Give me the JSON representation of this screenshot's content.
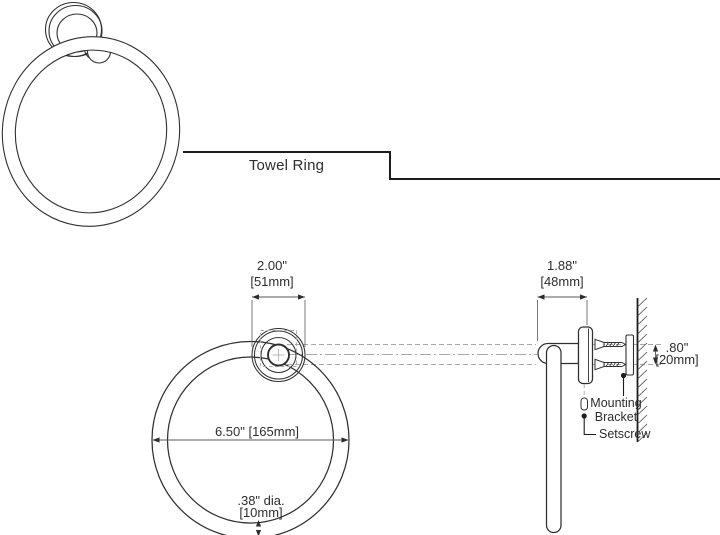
{
  "title": {
    "label": "Towel Ring"
  },
  "front_view": {
    "width_dim": {
      "inches": "2.00\"",
      "mm": "[51mm]"
    },
    "diameter_dim": {
      "value": "6.50\" [165mm]"
    },
    "tube_dim": {
      "inches": ".38\" dia.",
      "mm": "[10mm]"
    }
  },
  "side_view": {
    "depth_dim": {
      "inches": "1.88\"",
      "mm": "[48mm]"
    },
    "bracket_dim": {
      "inches": ".80\"",
      "mm": "[20mm]"
    },
    "mounting_bracket_label": {
      "line1": "Mounting",
      "line2": "Bracket"
    },
    "setscrew_label": "Setscrew"
  },
  "colors": {
    "outline": "#303032",
    "dimension_line": "#58585a",
    "centerline": "#a8a8a8",
    "text": "#2e2e30",
    "background": "#ffffff"
  }
}
